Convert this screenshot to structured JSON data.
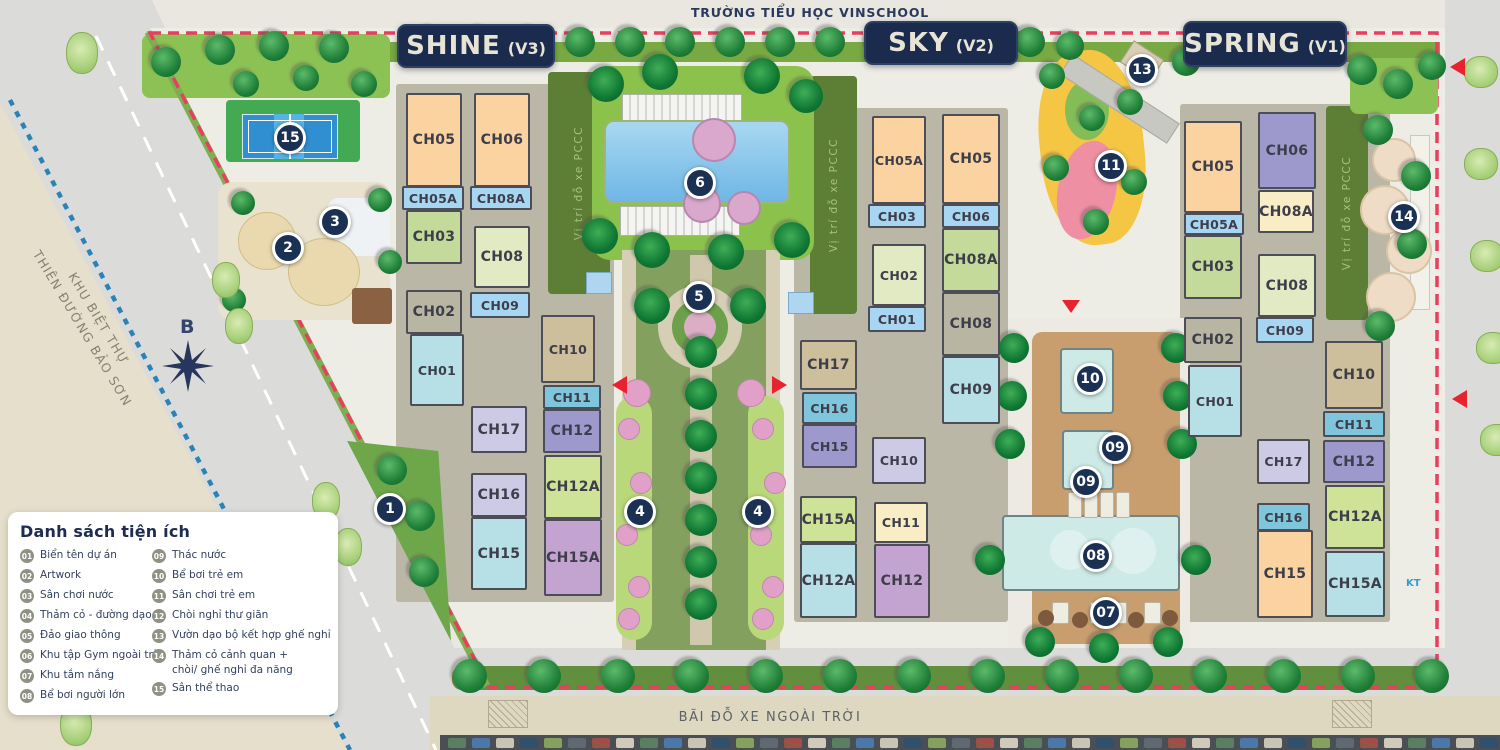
{
  "title_labels": {
    "top_road": "TRƯỜNG TIỂU HỌC VINSCHOOL",
    "bottom_area": "BÃI ĐỖ XE NGOÀI TRỜI",
    "left_area_line1": "KHU BIỆT THỰ",
    "left_area_line2": "THIÊN ĐƯỜNG BẢO SƠN",
    "compass": "B",
    "fire_lane": "Vị trí đỗ xe PCCC",
    "road_note": "KT"
  },
  "zones": [
    {
      "name": "SHINE",
      "code": "(V3)",
      "badge": {
        "x": 397,
        "y": 24,
        "w": 158,
        "h": 44
      },
      "blocks": [
        {
          "l": "CH05",
          "x": 406,
          "y": 93,
          "w": 56,
          "h": 94,
          "c": "peach"
        },
        {
          "l": "CH05A",
          "x": 402,
          "y": 186,
          "w": 62,
          "h": 24,
          "c": "lblue"
        },
        {
          "l": "CH03",
          "x": 406,
          "y": 210,
          "w": 56,
          "h": 54,
          "c": "green"
        },
        {
          "l": "CH02",
          "x": 406,
          "y": 290,
          "w": 56,
          "h": 44,
          "c": "graytan"
        },
        {
          "l": "CH01",
          "x": 410,
          "y": 334,
          "w": 54,
          "h": 72,
          "c": "cyan"
        },
        {
          "l": "CH06",
          "x": 474,
          "y": 93,
          "w": 56,
          "h": 94,
          "c": "peach"
        },
        {
          "l": "CH08A",
          "x": 470,
          "y": 186,
          "w": 62,
          "h": 24,
          "c": "lblue"
        },
        {
          "l": "CH08",
          "x": 474,
          "y": 226,
          "w": 56,
          "h": 62,
          "c": "palegreen"
        },
        {
          "l": "CH09",
          "x": 470,
          "y": 292,
          "w": 60,
          "h": 26,
          "c": "lblue"
        },
        {
          "l": "CH10",
          "x": 541,
          "y": 315,
          "w": 54,
          "h": 68,
          "c": "tan"
        },
        {
          "l": "CH11",
          "x": 543,
          "y": 385,
          "w": 58,
          "h": 24,
          "c": "teal"
        },
        {
          "l": "CH12",
          "x": 543,
          "y": 409,
          "w": 58,
          "h": 44,
          "c": "purple"
        },
        {
          "l": "CH17",
          "x": 471,
          "y": 406,
          "w": 56,
          "h": 47,
          "c": "lavender"
        },
        {
          "l": "CH16",
          "x": 471,
          "y": 473,
          "w": 56,
          "h": 44,
          "c": "lavender"
        },
        {
          "l": "CH15",
          "x": 471,
          "y": 517,
          "w": 56,
          "h": 73,
          "c": "cyan"
        },
        {
          "l": "CH12A",
          "x": 544,
          "y": 455,
          "w": 58,
          "h": 64,
          "c": "ygreen"
        },
        {
          "l": "CH15A",
          "x": 544,
          "y": 519,
          "w": 58,
          "h": 77,
          "c": "mauve"
        }
      ]
    },
    {
      "name": "SKY",
      "code": "(V2)",
      "badge": {
        "x": 864,
        "y": 21,
        "w": 154,
        "h": 44
      },
      "blocks": [
        {
          "l": "CH05A",
          "x": 872,
          "y": 116,
          "w": 54,
          "h": 88,
          "c": "peach"
        },
        {
          "l": "CH03",
          "x": 868,
          "y": 204,
          "w": 58,
          "h": 24,
          "c": "lblue"
        },
        {
          "l": "CH02",
          "x": 872,
          "y": 244,
          "w": 54,
          "h": 62,
          "c": "palegreen"
        },
        {
          "l": "CH01",
          "x": 868,
          "y": 306,
          "w": 58,
          "h": 26,
          "c": "lblue"
        },
        {
          "l": "CH05",
          "x": 942,
          "y": 114,
          "w": 58,
          "h": 90,
          "c": "peach"
        },
        {
          "l": "CH06",
          "x": 942,
          "y": 204,
          "w": 58,
          "h": 24,
          "c": "lblue"
        },
        {
          "l": "CH08A",
          "x": 942,
          "y": 228,
          "w": 58,
          "h": 64,
          "c": "green"
        },
        {
          "l": "CH08",
          "x": 942,
          "y": 292,
          "w": 58,
          "h": 64,
          "c": "graytan"
        },
        {
          "l": "CH09",
          "x": 942,
          "y": 356,
          "w": 58,
          "h": 68,
          "c": "cyan"
        },
        {
          "l": "CH17",
          "x": 800,
          "y": 340,
          "w": 57,
          "h": 50,
          "c": "tan"
        },
        {
          "l": "CH16",
          "x": 802,
          "y": 392,
          "w": 55,
          "h": 32,
          "c": "teal"
        },
        {
          "l": "CH15",
          "x": 802,
          "y": 424,
          "w": 55,
          "h": 44,
          "c": "purple"
        },
        {
          "l": "CH15A",
          "x": 800,
          "y": 496,
          "w": 57,
          "h": 47,
          "c": "ygreen"
        },
        {
          "l": "CH12A",
          "x": 800,
          "y": 543,
          "w": 57,
          "h": 75,
          "c": "cyan"
        },
        {
          "l": "CH10",
          "x": 872,
          "y": 437,
          "w": 54,
          "h": 47,
          "c": "lavender"
        },
        {
          "l": "CH11",
          "x": 874,
          "y": 502,
          "w": 54,
          "h": 41,
          "c": "cream"
        },
        {
          "l": "CH12",
          "x": 874,
          "y": 544,
          "w": 56,
          "h": 74,
          "c": "mauve"
        }
      ]
    },
    {
      "name": "SPRING",
      "code": "(V1)",
      "badge": {
        "x": 1183,
        "y": 21,
        "w": 164,
        "h": 46
      },
      "blocks": [
        {
          "l": "CH05",
          "x": 1184,
          "y": 121,
          "w": 58,
          "h": 92,
          "c": "peach"
        },
        {
          "l": "CH05A",
          "x": 1184,
          "y": 213,
          "w": 60,
          "h": 22,
          "c": "lblue"
        },
        {
          "l": "CH03",
          "x": 1184,
          "y": 235,
          "w": 58,
          "h": 64,
          "c": "green"
        },
        {
          "l": "CH02",
          "x": 1184,
          "y": 317,
          "w": 58,
          "h": 46,
          "c": "graytan"
        },
        {
          "l": "CH01",
          "x": 1188,
          "y": 365,
          "w": 54,
          "h": 72,
          "c": "cyan"
        },
        {
          "l": "CH06",
          "x": 1258,
          "y": 112,
          "w": 58,
          "h": 77,
          "c": "purple"
        },
        {
          "l": "CH08A",
          "x": 1258,
          "y": 190,
          "w": 56,
          "h": 43,
          "c": "cream"
        },
        {
          "l": "CH08",
          "x": 1258,
          "y": 254,
          "w": 58,
          "h": 63,
          "c": "palegreen"
        },
        {
          "l": "CH09",
          "x": 1256,
          "y": 317,
          "w": 58,
          "h": 26,
          "c": "lblue"
        },
        {
          "l": "CH10",
          "x": 1325,
          "y": 341,
          "w": 58,
          "h": 68,
          "c": "tan"
        },
        {
          "l": "CH11",
          "x": 1323,
          "y": 411,
          "w": 62,
          "h": 26,
          "c": "teal"
        },
        {
          "l": "CH12",
          "x": 1323,
          "y": 440,
          "w": 62,
          "h": 43,
          "c": "purple"
        },
        {
          "l": "CH12A",
          "x": 1325,
          "y": 485,
          "w": 60,
          "h": 64,
          "c": "ygreen"
        },
        {
          "l": "CH15A",
          "x": 1325,
          "y": 551,
          "w": 60,
          "h": 66,
          "c": "cyan"
        },
        {
          "l": "CH17",
          "x": 1257,
          "y": 439,
          "w": 53,
          "h": 45,
          "c": "lavender"
        },
        {
          "l": "CH16",
          "x": 1257,
          "y": 503,
          "w": 53,
          "h": 28,
          "c": "teal"
        },
        {
          "l": "CH15",
          "x": 1257,
          "y": 530,
          "w": 56,
          "h": 88,
          "c": "peach"
        }
      ]
    }
  ],
  "legend": {
    "title": "Danh sách tiện ích",
    "items": [
      {
        "num": "01",
        "label": "Biển tên dự án"
      },
      {
        "num": "02",
        "label": "Artwork"
      },
      {
        "num": "03",
        "label": "Sân chơi nước"
      },
      {
        "num": "04",
        "label": "Thảm cỏ - đường dạo"
      },
      {
        "num": "05",
        "label": "Đảo giao thông"
      },
      {
        "num": "06",
        "label": "Khu tập Gym ngoài trời"
      },
      {
        "num": "07",
        "label": "Khu tắm nắng"
      },
      {
        "num": "08",
        "label": "Bể bơi người lớn"
      },
      {
        "num": "09",
        "label": "Thác nước"
      },
      {
        "num": "10",
        "label": "Bể bơi trẻ em"
      },
      {
        "num": "11",
        "label": "Sân chơi trẻ em"
      },
      {
        "num": "12",
        "label": "Chòi nghỉ thư giãn"
      },
      {
        "num": "13",
        "label": "Vườn dạo bộ kết hợp ghế nghỉ"
      },
      {
        "num": "14",
        "label": "Thảm cỏ cảnh quan +",
        "label2": "chòi/ ghế nghỉ đa năng"
      },
      {
        "num": "15",
        "label": "Sân thể thao"
      }
    ]
  },
  "markers": [
    {
      "num": "1",
      "x": 390,
      "y": 509
    },
    {
      "num": "2",
      "x": 288,
      "y": 248
    },
    {
      "num": "3",
      "x": 335,
      "y": 222
    },
    {
      "num": "4",
      "x": 640,
      "y": 512
    },
    {
      "num": "4",
      "x": 758,
      "y": 512
    },
    {
      "num": "5",
      "x": 699,
      "y": 297
    },
    {
      "num": "6",
      "x": 700,
      "y": 183
    },
    {
      "num": "07",
      "x": 1106,
      "y": 613
    },
    {
      "num": "08",
      "x": 1096,
      "y": 556
    },
    {
      "num": "09",
      "x": 1115,
      "y": 448
    },
    {
      "num": "09",
      "x": 1086,
      "y": 482
    },
    {
      "num": "10",
      "x": 1090,
      "y": 379
    },
    {
      "num": "11",
      "x": 1111,
      "y": 166
    },
    {
      "num": "13",
      "x": 1142,
      "y": 70
    },
    {
      "num": "14",
      "x": 1404,
      "y": 217
    },
    {
      "num": "15",
      "x": 290,
      "y": 138
    }
  ],
  "colors": {
    "blocks": {
      "peach": "#fbd3a1",
      "lblue": "#a6d6f2",
      "green": "#c3da9b",
      "palegreen": "#e2eac4",
      "graytan": "#b8b6a3",
      "cyan": "#b6e0e5",
      "tan": "#cdbf9c",
      "teal": "#7fc5dc",
      "purple": "#9d99cc",
      "lavender": "#cdcae6",
      "ygreen": "#cfe398",
      "mauve": "#c3a4d0",
      "cream": "#f8edc5"
    },
    "accents": {
      "marker": "#1b3154",
      "badge": "#1a2b4d",
      "boundary": "#e83f5e",
      "fire_lane_strip": "#5d7e35",
      "legend_num": "#8f9183"
    }
  }
}
